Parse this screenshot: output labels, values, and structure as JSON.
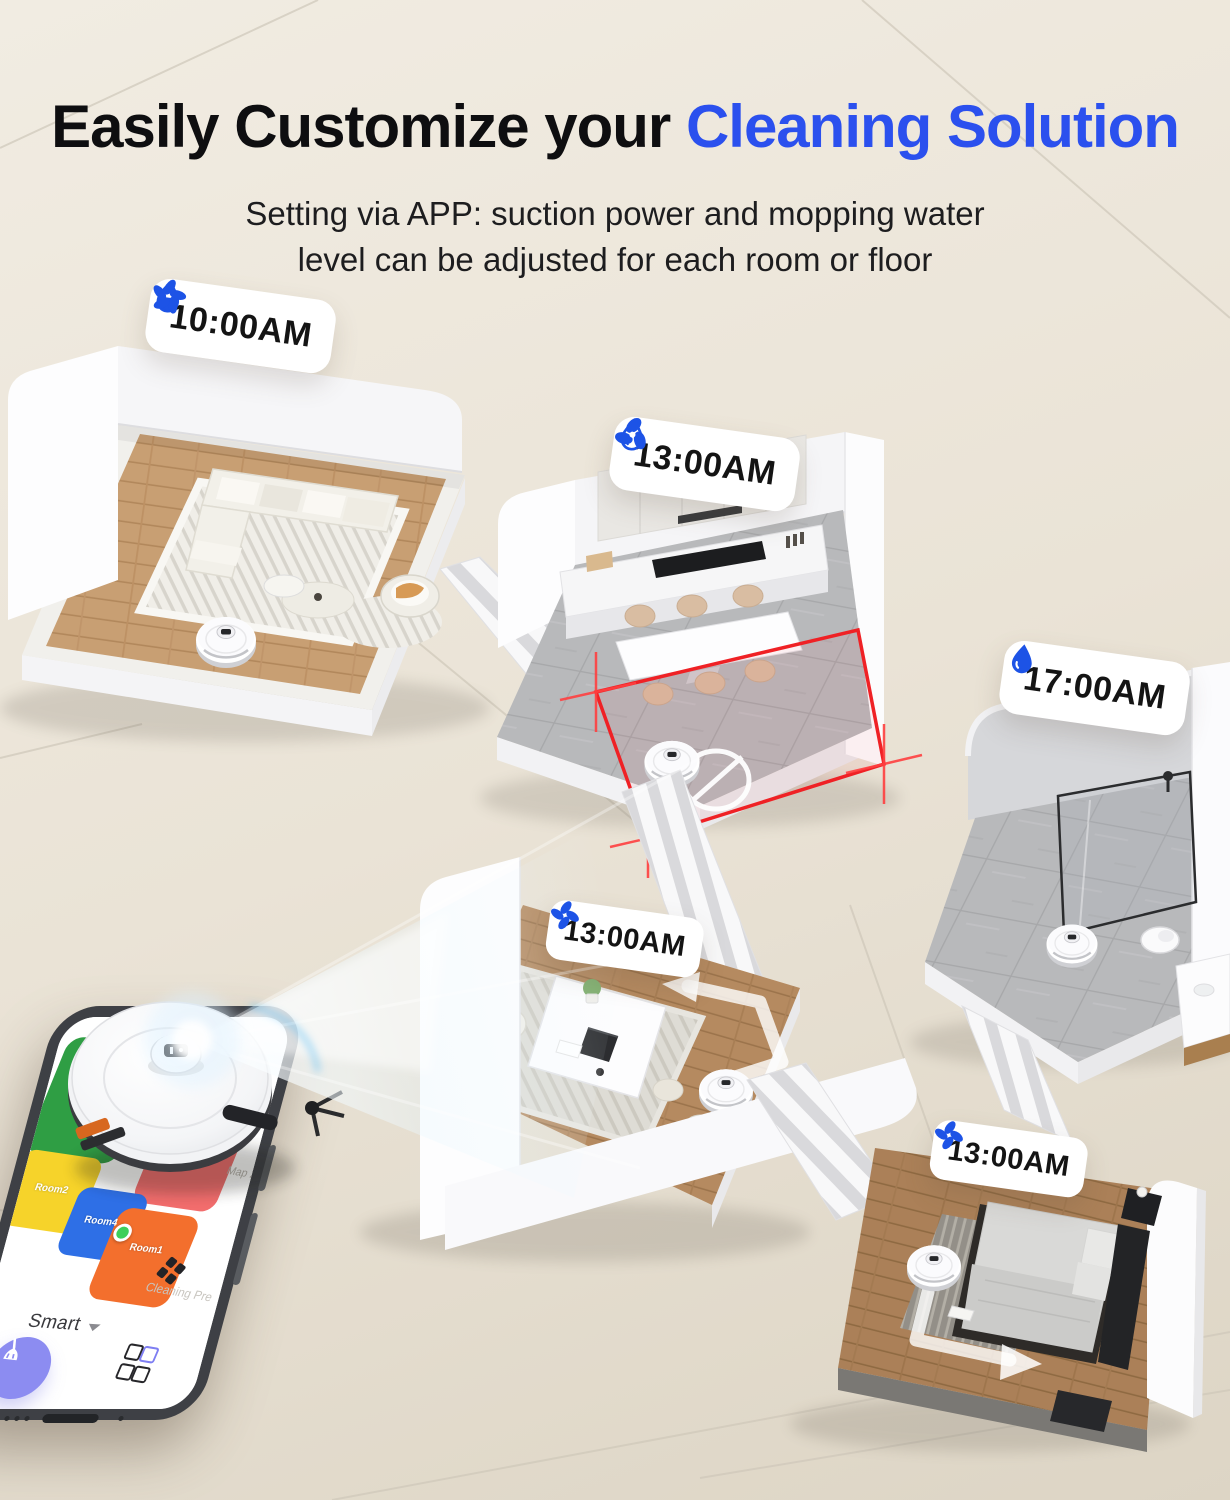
{
  "header": {
    "title_black": "Easily Customize your ",
    "title_blue": "Cleaning Solution",
    "subtitle_line1": "Setting via APP: suction power and mopping water",
    "subtitle_line2": "level can be adjusted for each room or floor"
  },
  "badges": [
    {
      "room": "living-room",
      "time": "10:00AM",
      "icons": [
        "water-drop-half-icon",
        "fan-5-blade-icon"
      ]
    },
    {
      "room": "kitchen",
      "time": "13:00AM",
      "icons": [
        "water-drop-outline-icon",
        "fan-3-blade-icon"
      ]
    },
    {
      "room": "bathroom",
      "time": "17:00AM",
      "icons": [
        "water-drop-solid-icon"
      ]
    },
    {
      "room": "office",
      "time": "13:00AM",
      "icons": [
        "fan-4-blade-icon"
      ]
    },
    {
      "room": "bedroom",
      "time": "13:00AM",
      "icons": [
        "fan-4-blade-icon"
      ]
    }
  ],
  "phone_app": {
    "mode_label": "Smart",
    "map_label": "Map 2",
    "preference_label": "Cleaning Pre",
    "icons": [
      "clean-broom-icon",
      "apps-grid-icon",
      "rooms-grid-icon",
      "chevron-down-icon",
      "robot-position-dot"
    ],
    "rooms": [
      {
        "label": "Room3",
        "color": "#2f9e44"
      },
      {
        "label": "",
        "color": "#8ed44f"
      },
      {
        "label": "Room7",
        "color": "#35d39a"
      },
      {
        "label": "Room5",
        "color": "#f26d6d"
      },
      {
        "label": "Room2",
        "color": "#f6d32a"
      },
      {
        "label": "Room4",
        "color": "#2e6fe6"
      },
      {
        "label": "Room1",
        "color": "#f36f2d"
      }
    ]
  },
  "colors": {
    "accent_blue": "#2b50ee",
    "icon_blue": "#1d53e6",
    "no_go_red": "#ef2125",
    "clean_button_purple": "#8c8cf1",
    "background_beige": "#eae3d6"
  }
}
